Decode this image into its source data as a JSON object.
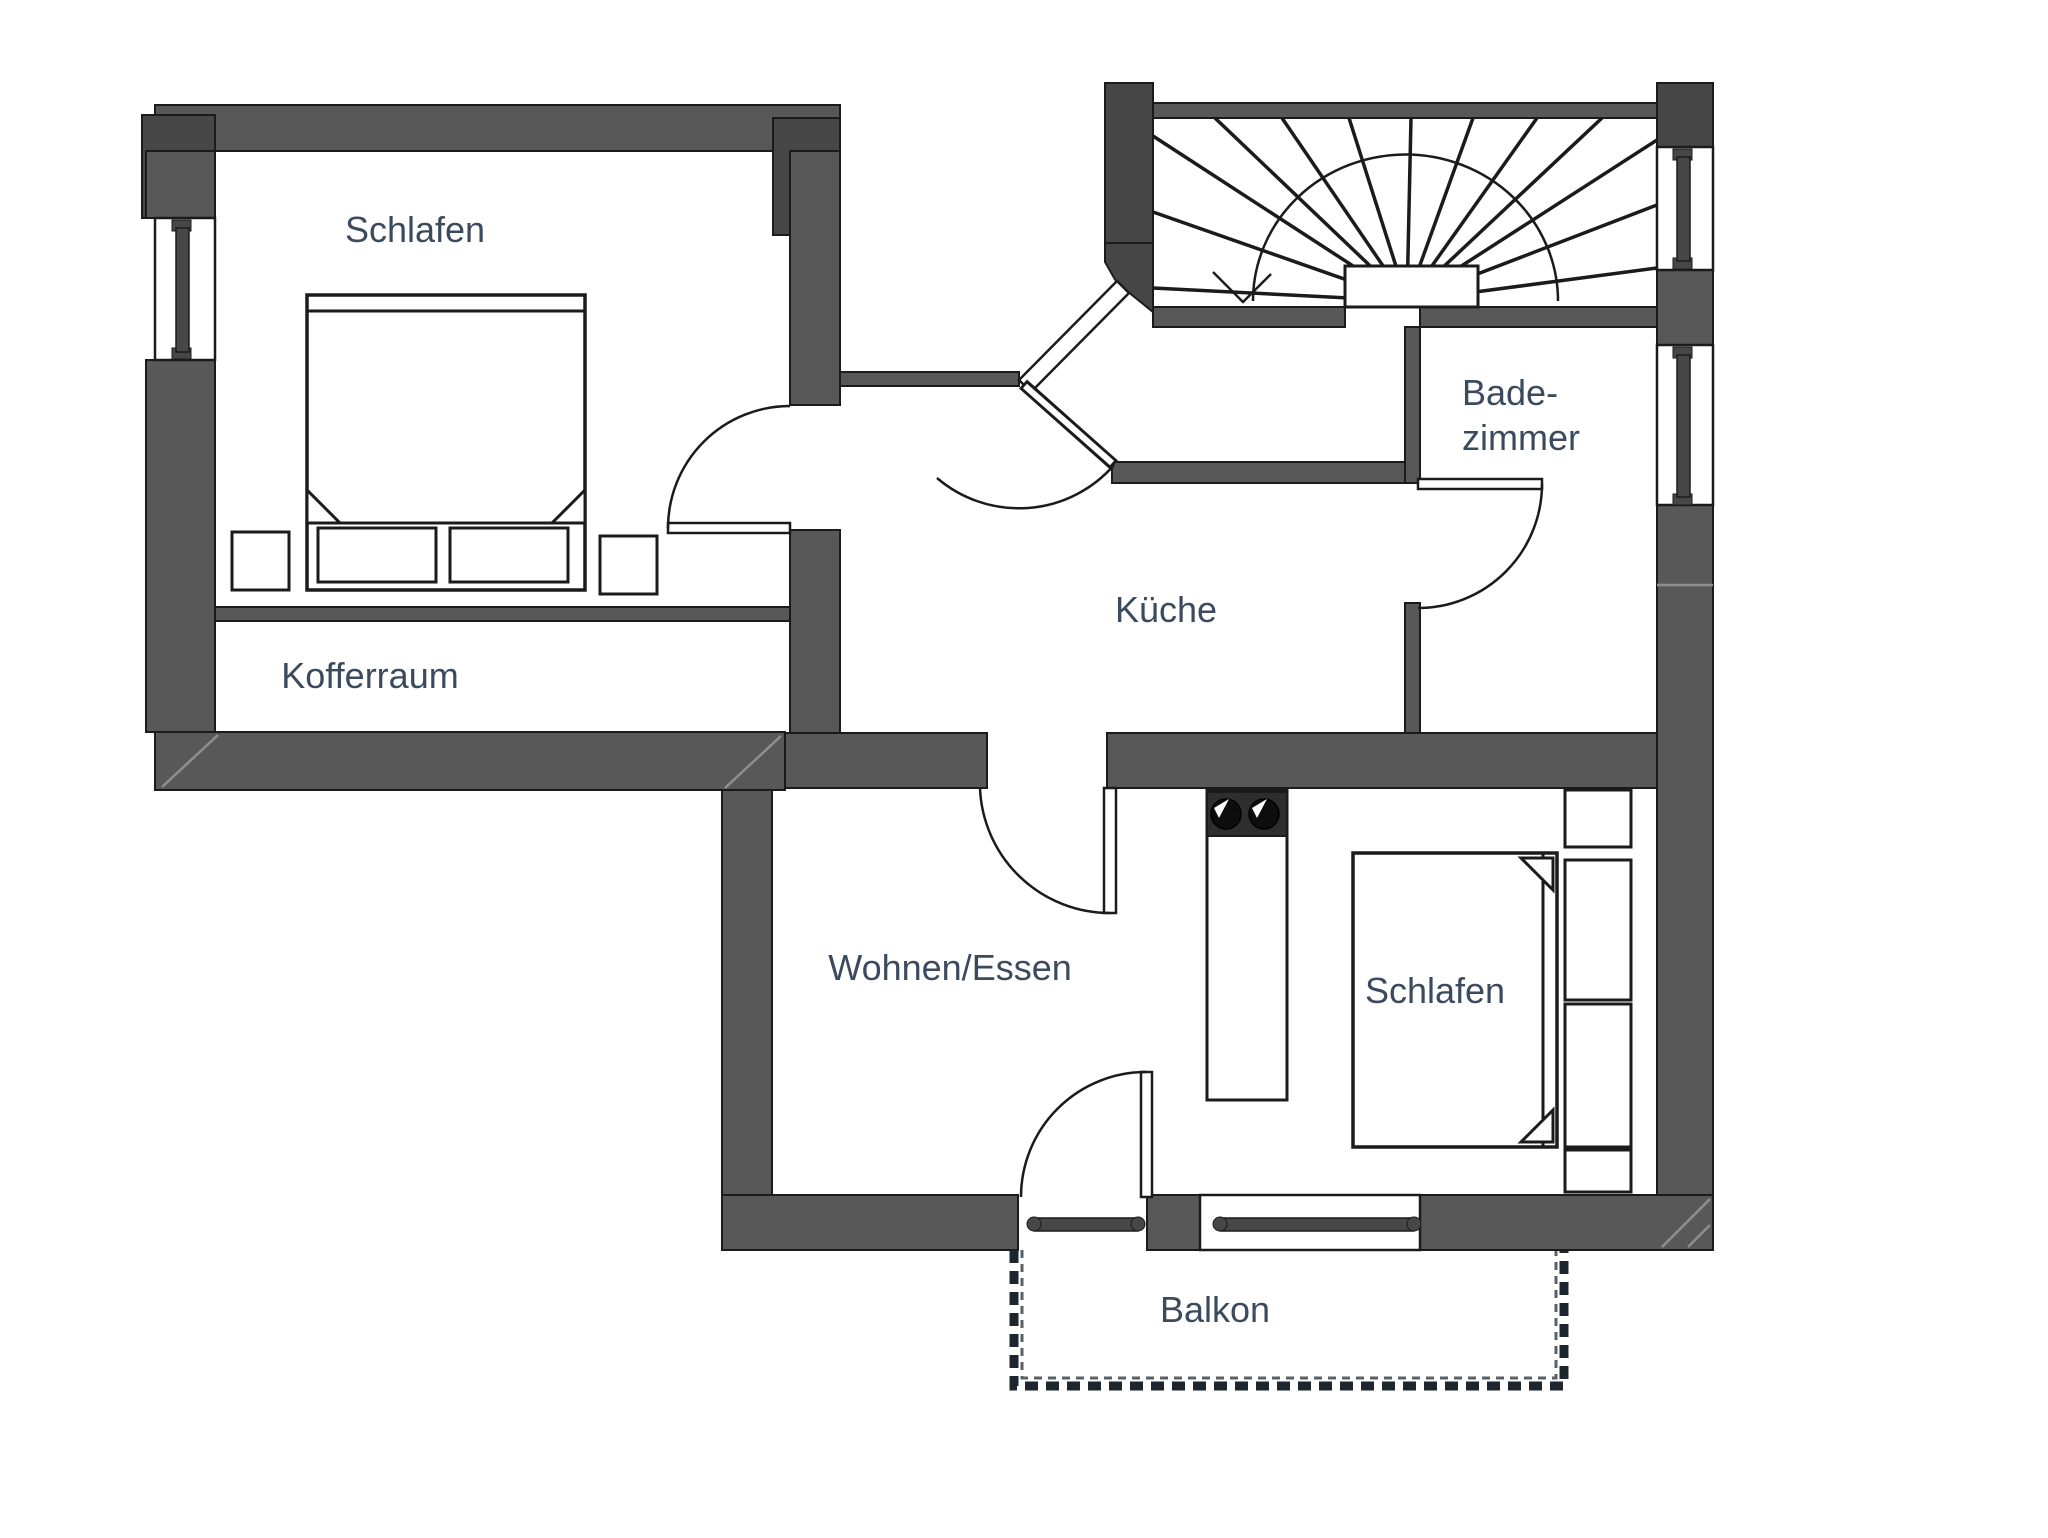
{
  "colors": {
    "wall": "#585858",
    "pillar": "#474747",
    "line": "#1b1b1b",
    "label": "#3c4a5e",
    "cooktop": "#2e2e2e",
    "railing": "#1d262e",
    "background": "#ffffff"
  },
  "rooms": {
    "schlafen1": {
      "label": "Schlafen"
    },
    "kofferraum": {
      "label": "Kofferraum"
    },
    "kueche": {
      "label": "Küche"
    },
    "badezimmer": {
      "line1": "Bade-",
      "line2": "zimmer"
    },
    "wohnen_essen": {
      "label": "Wohnen/Essen"
    },
    "schlafen2": {
      "label": "Schlafen"
    },
    "balkon": {
      "label": "Balkon"
    }
  }
}
